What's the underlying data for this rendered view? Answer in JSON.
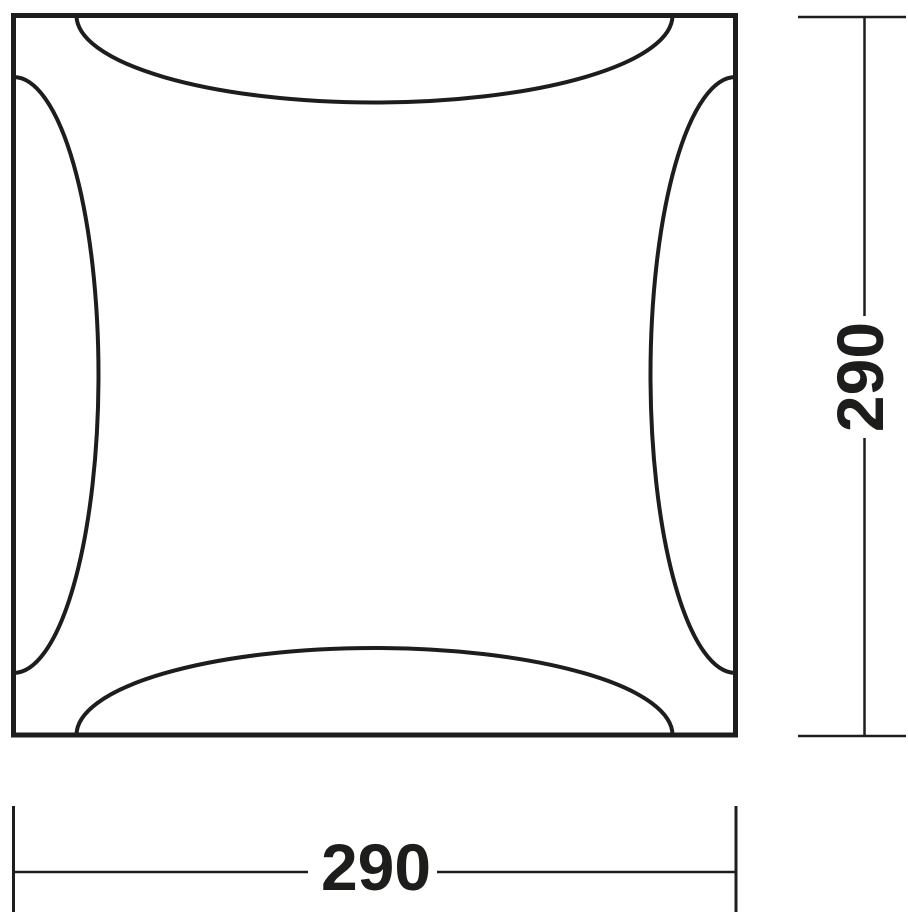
{
  "diagram": {
    "width_dimension": "290",
    "height_dimension": "290",
    "line_color": "#1d1d1b",
    "background_color": "#ffffff"
  }
}
